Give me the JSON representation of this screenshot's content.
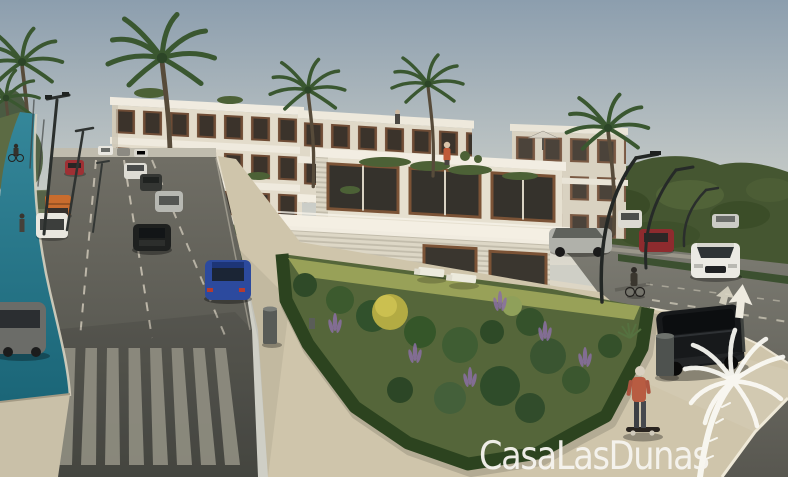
{
  "watermark": {
    "brand": "CasaLasDunas",
    "logo": "palm-tree-icon",
    "text_color": "#f7f5f0"
  },
  "scene": {
    "type": "architectural-render",
    "subject": "modern terraced apartment complex with gardens, roads and palm trees",
    "palette": {
      "sky_top": "#8c9eae",
      "sky_horizon": "#dcd9cd",
      "building_facade": "#e3dccb",
      "window_wood": "#6f4c35",
      "window_glass": "#3b332b",
      "hills": "#455631",
      "hedge": "#2c431f",
      "garden": "#55663a",
      "lawn": "#98a158",
      "asphalt": "#55564f",
      "sidewalk": "#cfc5ab",
      "bike_lane": "#2a7d90",
      "crosswalk_stripe": "#918f82"
    },
    "elements": {
      "palm_trees": 6,
      "street_lamps_left": 3,
      "street_lamps_right": 3,
      "cars_left_road": 8,
      "cars_right_road": 5,
      "parked_black_suv": 1,
      "people": [
        "skateboarder",
        "cyclist-bike-lane",
        "pedestrian-bike-lane",
        "cyclist-right",
        "terrace-person",
        "roof-person"
      ],
      "street_furniture": [
        "trash-bin",
        "trash-bin",
        "arrow-sign",
        "sun-loungers",
        "parasol"
      ]
    }
  }
}
